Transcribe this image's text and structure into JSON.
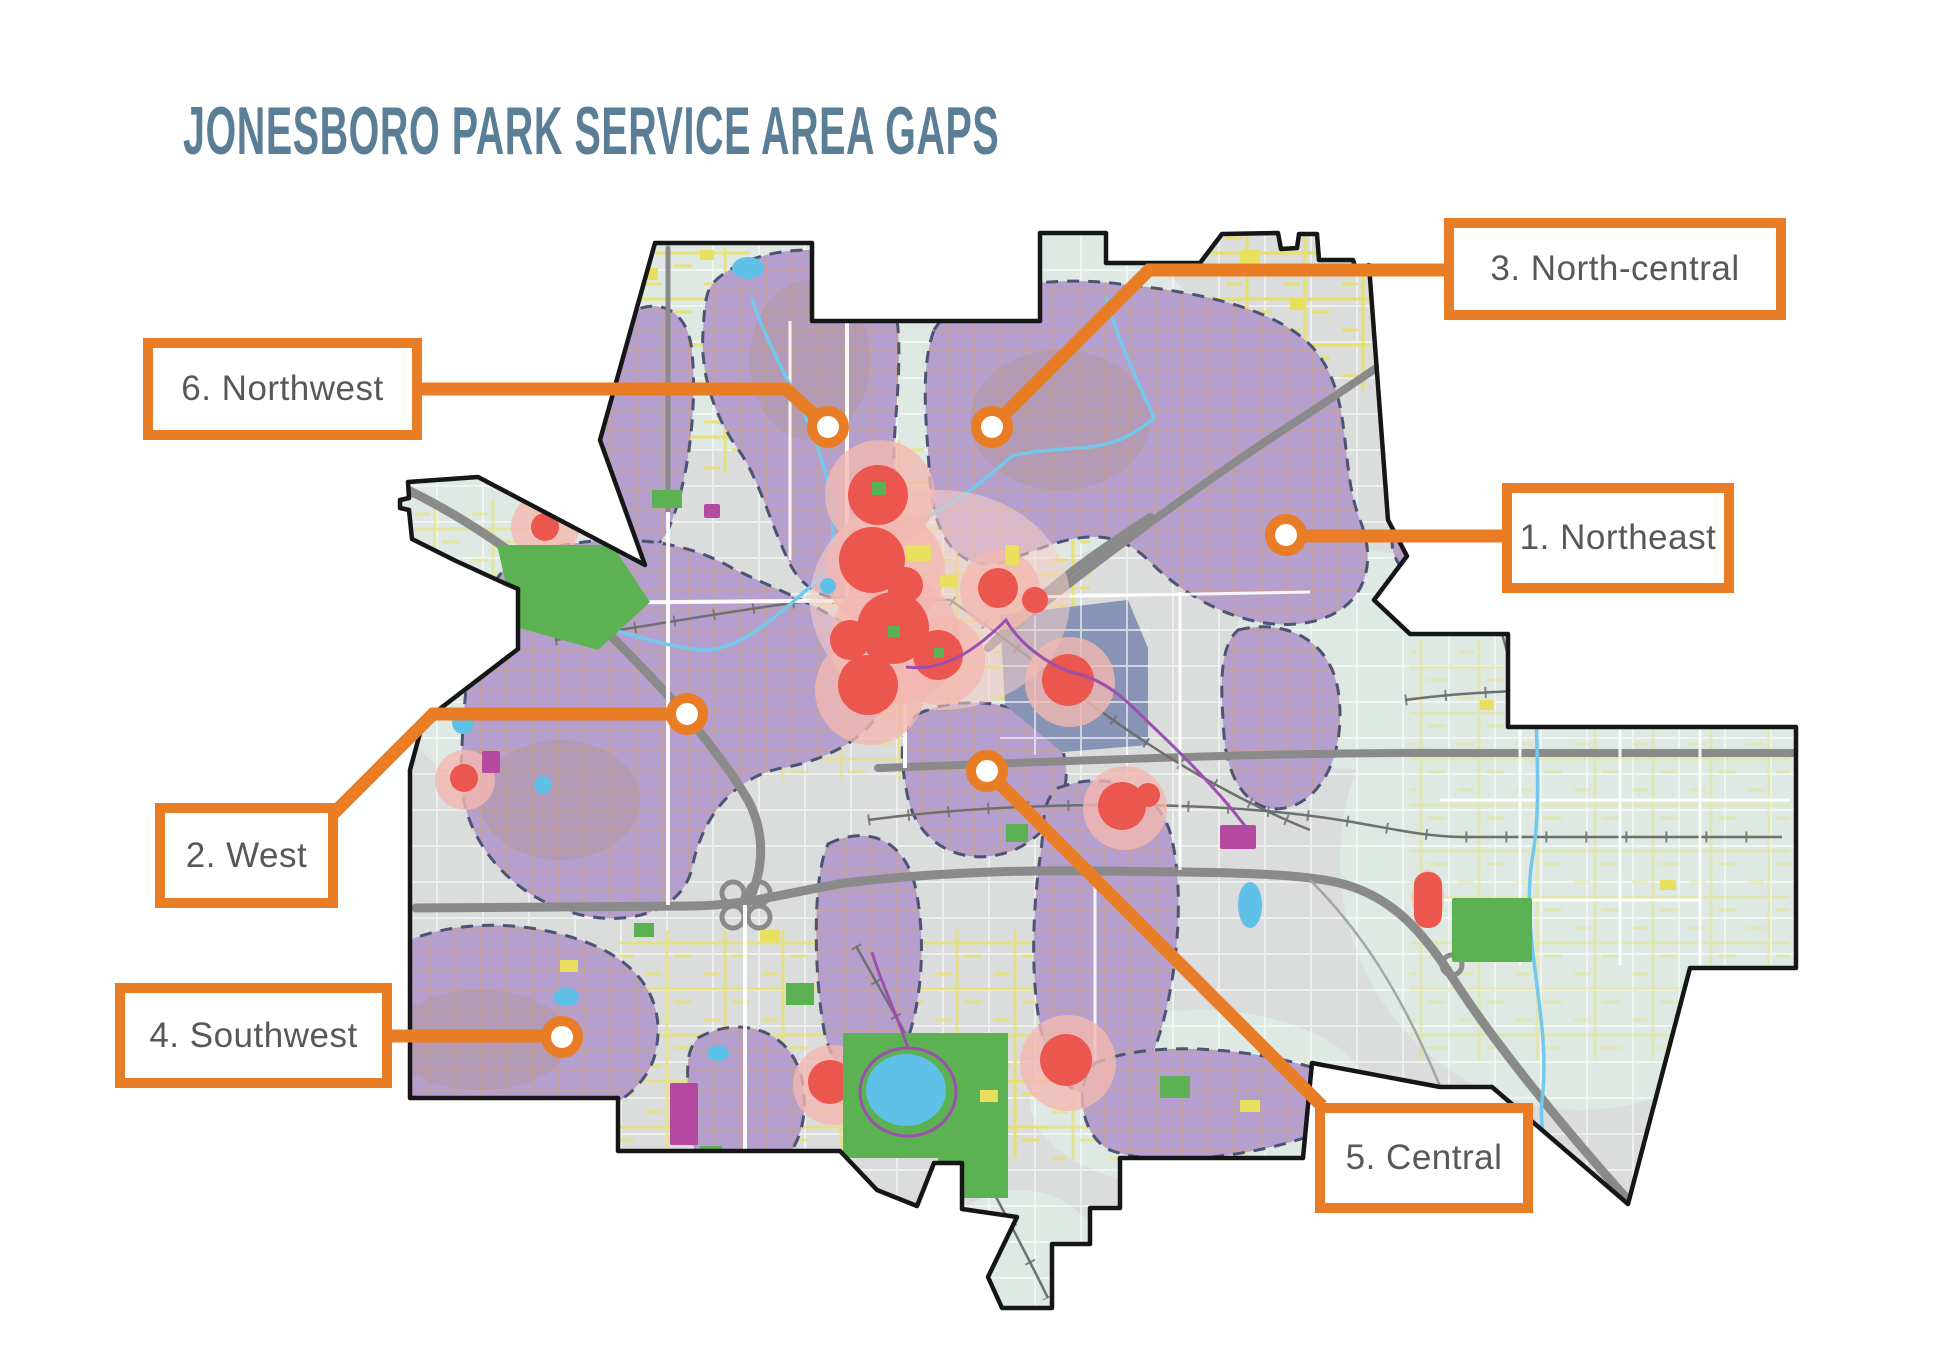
{
  "title": "JONESBORO PARK SERVICE AREA GAPS",
  "colors": {
    "accent_orange": "#E87D26",
    "title_blue": "#5B7E97",
    "label_gray": "#57585A",
    "gap_purple": "#B59FCE",
    "gap_border_navy": "#4C5374",
    "park_green": "#5CB252",
    "water_blue": "#5FC0E8",
    "heat_red": "#EB564E",
    "heat_pink": "#F3B8B1",
    "highway_gray": "#8A8A8A",
    "city_base_gray": "#DADDDC",
    "sage_green_gray": "#DEE9E3",
    "road_yellow": "#E9E05F",
    "magenta": "#B5489F",
    "downtown_slate": "#8794B5",
    "boundary_black": "#161616"
  },
  "map": {
    "callouts": [
      {
        "label": "1. Northeast",
        "marker_x": 1286,
        "marker_y": 535
      },
      {
        "label": "2. West",
        "marker_x": 687,
        "marker_y": 714
      },
      {
        "label": "3. North-central",
        "marker_x": 992,
        "marker_y": 427
      },
      {
        "label": "4. Southwest",
        "marker_x": 562,
        "marker_y": 1037
      },
      {
        "label": "5. Central",
        "marker_x": 987,
        "marker_y": 771
      },
      {
        "label": "6. Northwest",
        "marker_x": 828,
        "marker_y": 427
      }
    ]
  }
}
